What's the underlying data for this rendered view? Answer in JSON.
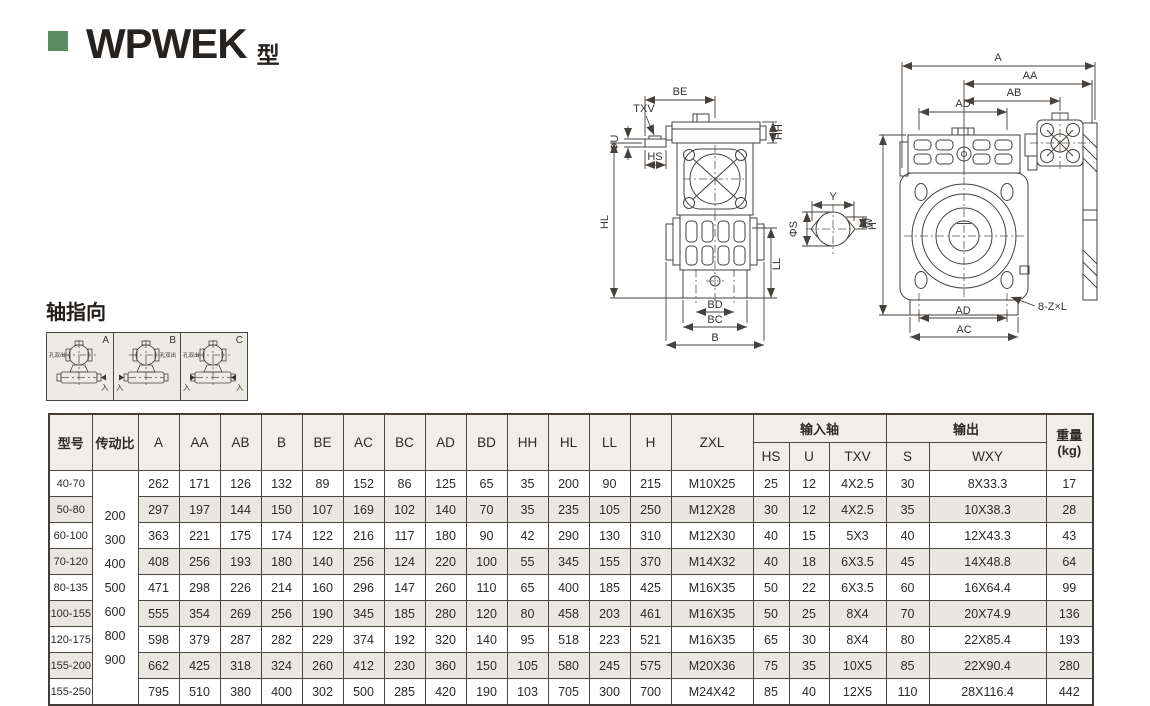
{
  "page": {
    "title_main": "WPWEK",
    "title_suffix": "型",
    "accent_green": "#5a8c60"
  },
  "axis_section": {
    "title": "轴指向",
    "hole_label": "孔双出",
    "input_label": "入",
    "boxes": [
      {
        "label": "A"
      },
      {
        "label": "B"
      },
      {
        "label": "C"
      }
    ]
  },
  "drawing": {
    "labels": {
      "be": "BE",
      "txv": "TXV",
      "phi_u": "ΦU",
      "hs": "HS",
      "hh": "HH",
      "hl": "HL",
      "ll": "LL",
      "bd": "BD",
      "bc": "BC",
      "b": "B",
      "y": "Y",
      "w": "W",
      "phi_s": "ΦS",
      "a": "A",
      "aa": "AA",
      "ab": "AB",
      "ad_top": "AD",
      "ad_bottom": "AD",
      "ac": "AC",
      "h": "H",
      "holes": "8-Z×L"
    }
  },
  "table": {
    "headers": {
      "model": "型号",
      "ratio": "传动比",
      "dims": [
        "A",
        "AA",
        "AB",
        "B",
        "BE",
        "AC",
        "BC",
        "AD",
        "BD",
        "HH",
        "HL",
        "LL",
        "H",
        "ZXL"
      ],
      "input_group": "输入轴",
      "input_cols": [
        "HS",
        "U",
        "TXV"
      ],
      "output_group": "输出",
      "output_cols": [
        "S",
        "WXY"
      ],
      "weight_line1": "重量",
      "weight_line2": "(kg)"
    },
    "ratio_values": [
      "200",
      "300",
      "400",
      "500",
      "600",
      "800",
      "900"
    ],
    "rows": [
      {
        "model": "40-70",
        "cells": [
          "262",
          "171",
          "126",
          "132",
          "89",
          "152",
          "86",
          "125",
          "65",
          "35",
          "200",
          "90",
          "215",
          "M10X25",
          "25",
          "12",
          "4X2.5",
          "30",
          "8X33.3",
          "17"
        ]
      },
      {
        "model": "50-80",
        "cells": [
          "297",
          "197",
          "144",
          "150",
          "107",
          "169",
          "102",
          "140",
          "70",
          "35",
          "235",
          "105",
          "250",
          "M12X28",
          "30",
          "12",
          "4X2.5",
          "35",
          "10X38.3",
          "28"
        ]
      },
      {
        "model": "60-100",
        "cells": [
          "363",
          "221",
          "175",
          "174",
          "122",
          "216",
          "117",
          "180",
          "90",
          "42",
          "290",
          "130",
          "310",
          "M12X30",
          "40",
          "15",
          "5X3",
          "40",
          "12X43.3",
          "43"
        ]
      },
      {
        "model": "70-120",
        "cells": [
          "408",
          "256",
          "193",
          "180",
          "140",
          "256",
          "124",
          "220",
          "100",
          "55",
          "345",
          "155",
          "370",
          "M14X32",
          "40",
          "18",
          "6X3.5",
          "45",
          "14X48.8",
          "64"
        ]
      },
      {
        "model": "80-135",
        "cells": [
          "471",
          "298",
          "226",
          "214",
          "160",
          "296",
          "147",
          "260",
          "110",
          "65",
          "400",
          "185",
          "425",
          "M16X35",
          "50",
          "22",
          "6X3.5",
          "60",
          "16X64.4",
          "99"
        ]
      },
      {
        "model": "100-155",
        "cells": [
          "555",
          "354",
          "269",
          "256",
          "190",
          "345",
          "185",
          "280",
          "120",
          "80",
          "458",
          "203",
          "461",
          "M16X35",
          "50",
          "25",
          "8X4",
          "70",
          "20X74.9",
          "136"
        ]
      },
      {
        "model": "120-175",
        "cells": [
          "598",
          "379",
          "287",
          "282",
          "229",
          "374",
          "192",
          "320",
          "140",
          "95",
          "518",
          "223",
          "521",
          "M16X35",
          "65",
          "30",
          "8X4",
          "80",
          "22X85.4",
          "193"
        ]
      },
      {
        "model": "155-200",
        "cells": [
          "662",
          "425",
          "318",
          "324",
          "260",
          "412",
          "230",
          "360",
          "150",
          "105",
          "580",
          "245",
          "575",
          "M20X36",
          "75",
          "35",
          "10X5",
          "85",
          "22X90.4",
          "280"
        ]
      },
      {
        "model": "155-250",
        "cells": [
          "795",
          "510",
          "380",
          "400",
          "302",
          "500",
          "285",
          "420",
          "190",
          "103",
          "705",
          "300",
          "700",
          "M24X42",
          "85",
          "40",
          "12X5",
          "110",
          "28X116.4",
          "442"
        ]
      }
    ]
  }
}
